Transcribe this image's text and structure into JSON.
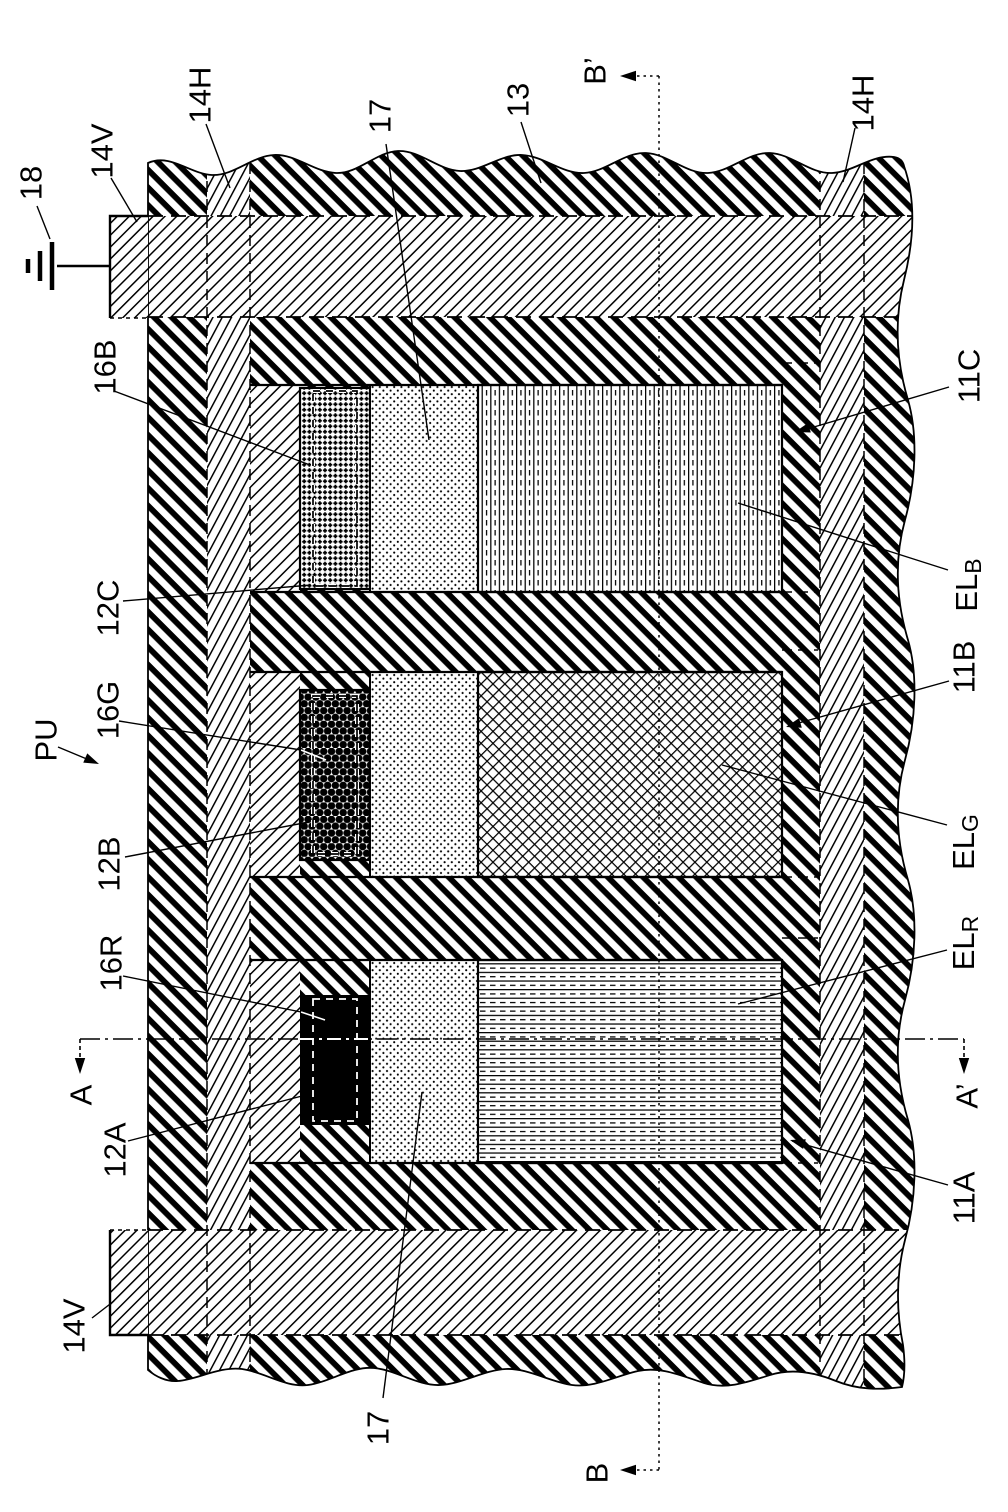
{
  "labels": {
    "ground": "18",
    "power_line_vertical_top": "14V",
    "power_line_horizontal_left": "14H",
    "organic_layer_top": "17",
    "bank": "13",
    "section_b_prime": "B’",
    "power_line_horizontal_right": "14H",
    "pixel_unit": "PU",
    "contact_16b": "16B",
    "via_12c": "12C",
    "contact_16g": "16G",
    "via_12b": "12B",
    "contact_16r": "16R",
    "via_12a": "12A",
    "section_a": "A",
    "power_line_vertical_bottom": "14V",
    "organic_layer_bottom": "17",
    "section_b": "B",
    "anode_11c": "11C",
    "anode_11b": "11B",
    "anode_11a": "11A",
    "section_a_prime": "A’"
  },
  "el_layers": {
    "blue": {
      "main": "EL",
      "sub": "B"
    },
    "green": {
      "main": "EL",
      "sub": "G"
    },
    "red": {
      "main": "EL",
      "sub": "R"
    }
  },
  "colors": {
    "ink": "#000000",
    "paper": "#ffffff"
  }
}
